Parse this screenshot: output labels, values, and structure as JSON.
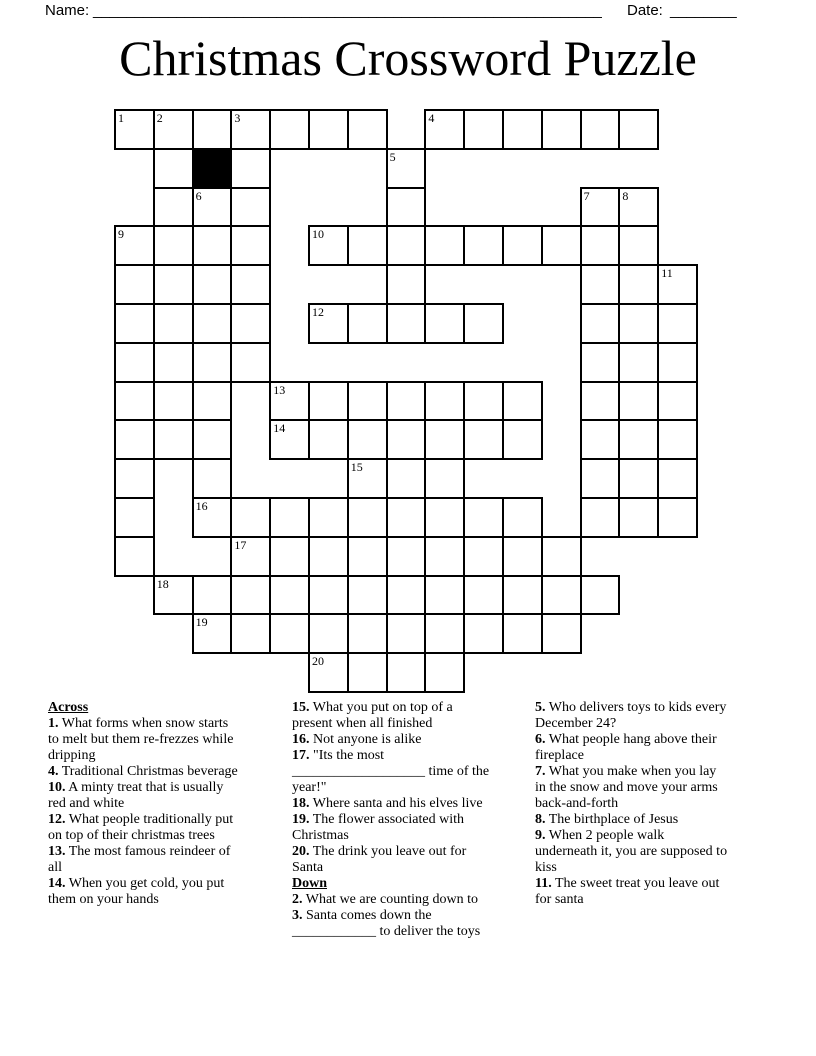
{
  "header": {
    "name_label": "Name:",
    "name_line": "_____________________________________________________________",
    "date_label": "Date:",
    "date_line": "________",
    "title": "Christmas Crossword Puzzle"
  },
  "grid": {
    "origin_x": 115,
    "origin_y": 110,
    "cell_size": 38.8,
    "line_color": "#000000",
    "cell_fill": "#ffffff",
    "black_fill": "#000000",
    "rows": [
      {
        "r": 0,
        "runs": [
          [
            0,
            6
          ],
          [
            8,
            13
          ]
        ]
      },
      {
        "r": 1,
        "runs": [
          [
            1,
            3
          ],
          [
            7,
            7
          ]
        ]
      },
      {
        "r": 2,
        "runs": [
          [
            1,
            3
          ],
          [
            7,
            7
          ],
          [
            12,
            13
          ]
        ]
      },
      {
        "r": 3,
        "runs": [
          [
            0,
            3
          ],
          [
            5,
            13
          ]
        ]
      },
      {
        "r": 4,
        "runs": [
          [
            0,
            3
          ],
          [
            7,
            7
          ],
          [
            12,
            14
          ]
        ]
      },
      {
        "r": 5,
        "runs": [
          [
            0,
            3
          ],
          [
            5,
            9
          ],
          [
            12,
            14
          ]
        ]
      },
      {
        "r": 6,
        "runs": [
          [
            0,
            3
          ],
          [
            12,
            14
          ]
        ]
      },
      {
        "r": 7,
        "runs": [
          [
            0,
            2
          ],
          [
            4,
            10
          ],
          [
            12,
            14
          ]
        ]
      },
      {
        "r": 8,
        "runs": [
          [
            0,
            2
          ],
          [
            4,
            10
          ],
          [
            12,
            14
          ]
        ]
      },
      {
        "r": 9,
        "runs": [
          [
            0,
            0
          ],
          [
            2,
            2
          ],
          [
            6,
            8
          ],
          [
            12,
            14
          ]
        ]
      },
      {
        "r": 10,
        "runs": [
          [
            0,
            0
          ],
          [
            2,
            10
          ],
          [
            12,
            14
          ]
        ]
      },
      {
        "r": 11,
        "runs": [
          [
            0,
            0
          ],
          [
            3,
            11
          ]
        ]
      },
      {
        "r": 12,
        "runs": [
          [
            1,
            12
          ]
        ]
      },
      {
        "r": 13,
        "runs": [
          [
            2,
            11
          ]
        ]
      },
      {
        "r": 14,
        "runs": [
          [
            5,
            8
          ]
        ]
      }
    ],
    "numbers": {
      "1": [
        0,
        0
      ],
      "2": [
        0,
        1
      ],
      "3": [
        0,
        3
      ],
      "4": [
        0,
        8
      ],
      "5": [
        1,
        7
      ],
      "6": [
        2,
        2
      ],
      "7": [
        2,
        12
      ],
      "8": [
        2,
        13
      ],
      "9": [
        3,
        0
      ],
      "10": [
        3,
        5
      ],
      "11": [
        4,
        14
      ],
      "12": [
        5,
        5
      ],
      "13": [
        7,
        4
      ],
      "14": [
        8,
        4
      ],
      "15": [
        9,
        6
      ],
      "16": [
        10,
        2
      ],
      "17": [
        11,
        3
      ],
      "18": [
        12,
        1
      ],
      "19": [
        13,
        2
      ],
      "20": [
        14,
        5
      ]
    },
    "black_cells": [
      [
        1,
        2
      ]
    ]
  },
  "clues": {
    "columns": [
      {
        "entries": [
          {
            "heading": "Across"
          },
          {
            "num": "1.",
            "text": "What forms when snow starts to melt but them re-frezzes while dripping"
          },
          {
            "num": "4.",
            "text": "Traditional Christmas beverage"
          },
          {
            "num": "10.",
            "text": "A minty treat that is usually red and white"
          },
          {
            "num": "12.",
            "text": "What people traditionally put on top of their christmas trees"
          },
          {
            "num": "13.",
            "text": "The most famous reindeer of all"
          },
          {
            "num": "14.",
            "text": "When you get cold, you put them on your hands"
          }
        ]
      },
      {
        "entries": [
          {
            "num": "15.",
            "text": "What you put on top of a present when all finished"
          },
          {
            "num": "16.",
            "text": "Not anyone is alike"
          },
          {
            "num": "17.",
            "text": "\"Its the most ___________________ time of the year!\""
          },
          {
            "num": "18.",
            "text": "Where santa and his elves live"
          },
          {
            "num": "19.",
            "text": "The flower associated with Christmas"
          },
          {
            "num": "20.",
            "text": "The drink you leave out for Santa"
          },
          {
            "heading": "Down"
          },
          {
            "num": "2.",
            "text": "What we are counting down to"
          },
          {
            "num": "3.",
            "text": "Santa comes down the ____________ to deliver the toys"
          }
        ]
      },
      {
        "entries": [
          {
            "num": "5.",
            "text": "Who delivers toys to kids every December 24?"
          },
          {
            "num": "6.",
            "text": "What people hang above their fireplace"
          },
          {
            "num": "7.",
            "text": "What you make when you lay in the snow and move your arms back-and-forth"
          },
          {
            "num": "8.",
            "text": "The birthplace of Jesus"
          },
          {
            "num": "9.",
            "text": "When 2 people walk underneath it, you are supposed to kiss"
          },
          {
            "num": "11.",
            "text": "The sweet treat you leave out for santa"
          }
        ]
      }
    ]
  }
}
